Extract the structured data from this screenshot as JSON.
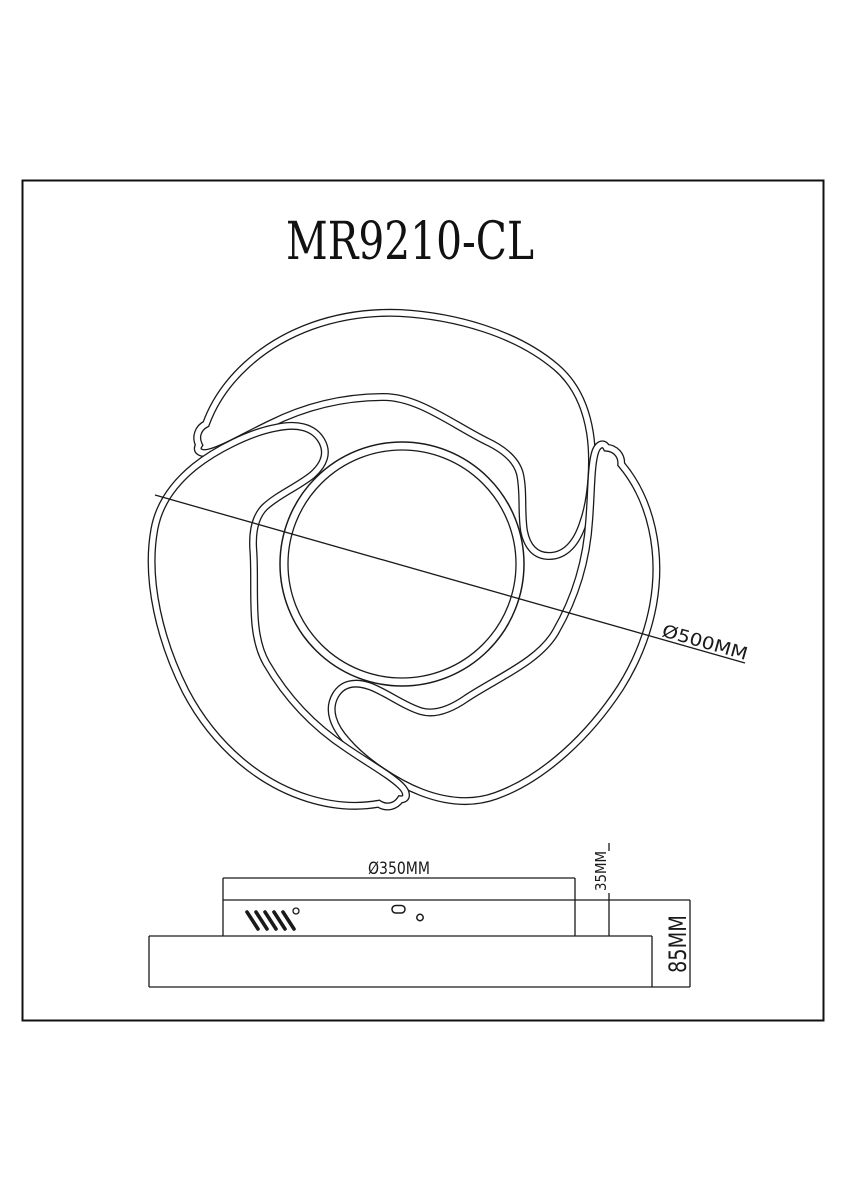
{
  "page": {
    "background": "#ffffff",
    "line_color": "#1a1a1a"
  },
  "drawing": {
    "title": "MR9210-CL",
    "dimensions": {
      "overall_diameter": "Ø500MM",
      "base_diameter": "Ø350MM",
      "base_height": "35MM",
      "total_height": "85MM"
    }
  }
}
